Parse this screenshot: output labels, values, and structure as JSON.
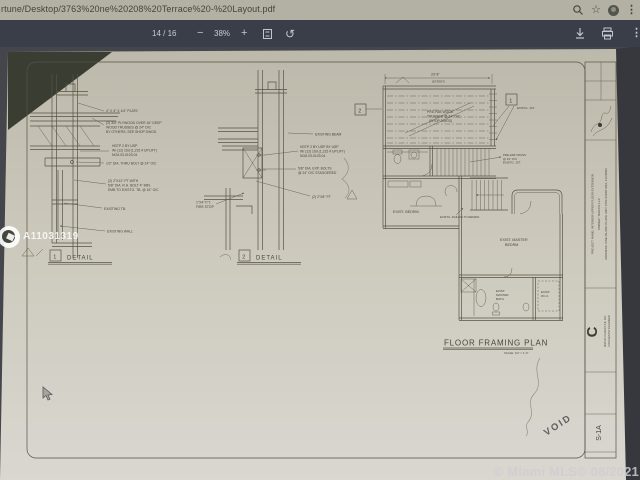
{
  "colors": {
    "address_bar_bg": "#b2b1a3",
    "pdf_toolbar_bg": "#3a3e49",
    "viewer_bg": "#44464c",
    "page_paper": "#ccc9bc",
    "drawing_ink": "#575346",
    "watermark_white": "#ffffff",
    "mls_watermark_gray": "#ceced2"
  },
  "browser": {
    "url": "rtune/Desktop/3763%20ne%20208%20Terrace%20-%20Layout.pdf",
    "icons": {
      "star_glyph": "☆",
      "overflow_glyph": "⋮"
    }
  },
  "pdf_toolbar": {
    "page_indicator": "14 / 16",
    "zoom_out_glyph": "−",
    "zoom_level": "38%",
    "zoom_in_glyph": "+",
    "rotate_glyph": "↺",
    "overflow_glyph": "⋮"
  },
  "watermarks": {
    "listing_id": "A11031319",
    "mls_credit": "© Miami MLS© 08/2021"
  },
  "sheet": {
    "detail1": {
      "number": "1",
      "label": "DETAIL",
      "note_plate": "4\" X 4\" X 1/4\" PLATE",
      "note_plywood1": "(2) 3/4\" PLYWOOD OVER 16\" DEEP",
      "note_plywood2": "WOOD TRUSSES @ 24\" O/C",
      "note_plywood3": "BY OTHERS, SEE SHOP DWGS.",
      "note_hdtp1": "HDTP 2 BY USP",
      "note_hdtp2": "W/ (12) 16d (1,215 # UPLIFT)",
      "note_hdtp3": "NOA 03-0103.04",
      "note_bolt": "1/2\" DIA. THRU BOLT @ 24\" O/C",
      "note_pt1": "(2) 2\"X12\" PT WITH",
      "note_pt2": "5/8\" DIA. R.H. BOLT 4\" MIN.",
      "note_pt3": "EMB TO EXISTG. TB. @ 16\" O/C",
      "note_tb": "EXISTING TB.",
      "note_wall": "EXISTING WALL"
    },
    "detail2": {
      "number": "2",
      "label": "DETAIL",
      "note_beam": "EXISTING BEAM",
      "note_hdtp1": "HDTP 2 BY USP BY USP",
      "note_hdtp2": "W/ (12) 16d (1,215 # UPLIFT)",
      "note_hdtp3": "NOA 03-0103.04",
      "note_bolts1": "5/8\" DIA. EXP. BOLTS",
      "note_bolts2": "@ 24\" O/C STAGGERED",
      "note_pt": "(2) 2\"X8\" PT",
      "note_firestop1": "1\"X4\" P.T.",
      "note_firestop2": "FIRE STOP"
    },
    "plan": {
      "dim": "23'-8\"",
      "dim_sub": "(EXTENT)",
      "callout1": "1",
      "callout2": "2",
      "truss_note1": "PRE-FAB WOOD",
      "truss_note2": "TRUSSES @ 24\" O/C",
      "truss_note3": "(SHOP DWGS)",
      "jst_note": "EXISTG. JST.",
      "joist_note1": "PRE-FAB TRUSS",
      "joist_note2": "@ 24\" O/C",
      "joist_note3": "EXISTG. JST.",
      "room_bedrm": "EXIST. BEDRM.",
      "railing_note": "EXISTG. RAILING TO REMAIN",
      "room_master1": "EXIST. MASTER",
      "room_master2": "BEDRM",
      "room_bath1": "EXIST.",
      "room_bath2": "MASTER",
      "room_bath3": "BATH",
      "room_wic1": "EXIST.",
      "room_wic2": "W.I.C.",
      "title": "FLOOR FRAMING PLAN",
      "scale": "SCALE: 1/4\" = 1'-0\""
    },
    "titleblock": {
      "project": "PROJECT NAME:   INTERIOR UPPER FLOOR EXTENSION",
      "owner": "OWNER:   TEOFOX LLC",
      "address": "ADDRESS:   ONE ISLAND PLACE UNIT 3703 AVENTURA, FLORIDA",
      "logo_letter": "C",
      "engineer1": "MILTON CLAROS P.E. INC.",
      "engineer2": "CONSULTANT ENGINEER",
      "sheet_number": "S-1A",
      "void_stamp": "VOID"
    }
  }
}
